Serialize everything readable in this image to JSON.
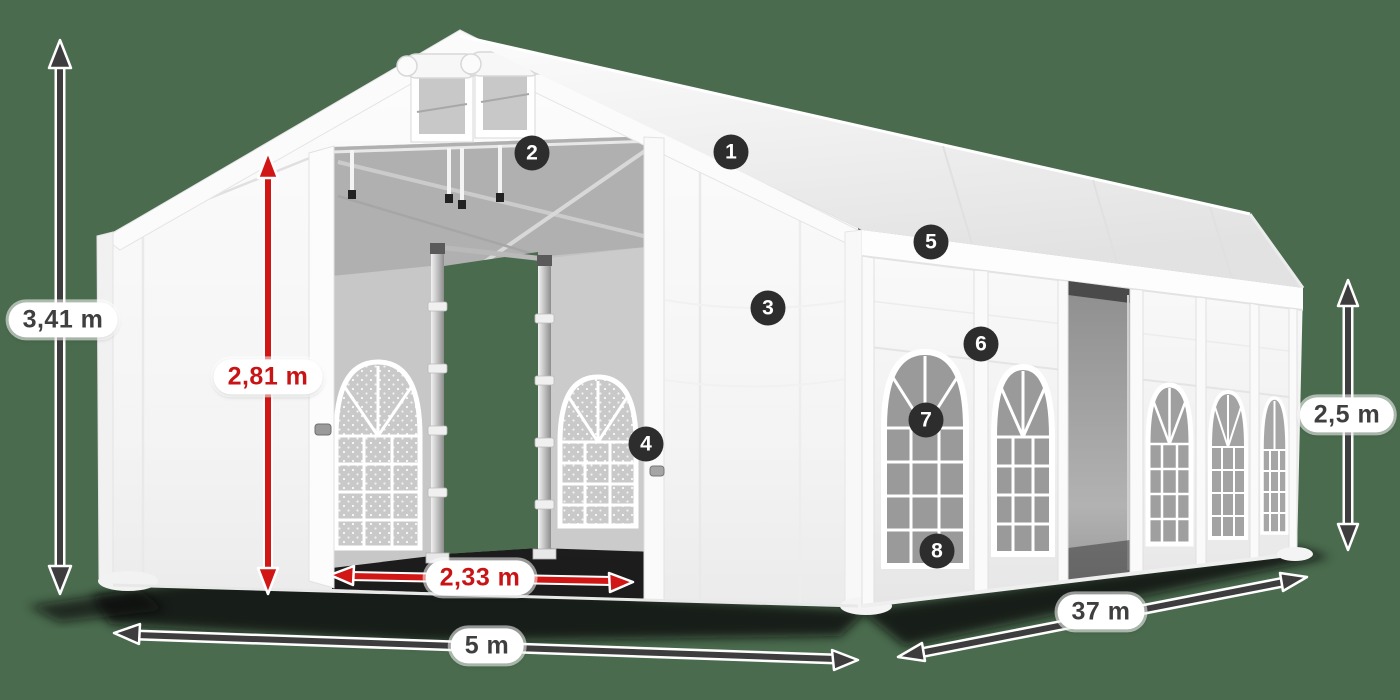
{
  "scene": {
    "name": "tent-dimension-diagram",
    "background_color": "#4a6b4e",
    "tent_color": "#ffffff",
    "red_accent": "#c81414",
    "dark_accent": "#3d3d3d",
    "badge_color": "#2d2d2d"
  },
  "dimension_labels": {
    "total_height": "3,41 m",
    "entrance_height": "2,81 m",
    "entrance_width": "2,33 m",
    "tent_width": "5 m",
    "tent_length": "37 m",
    "side_wall_height": "2,5 m"
  },
  "callouts": [
    "1",
    "2",
    "3",
    "4",
    "5",
    "6",
    "7",
    "8"
  ]
}
